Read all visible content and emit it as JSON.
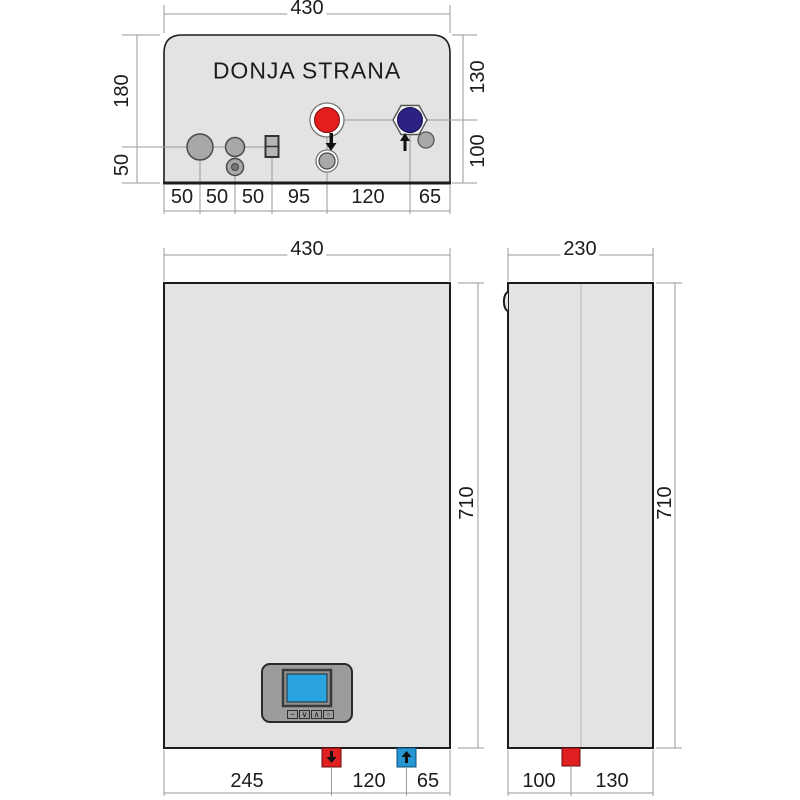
{
  "title": "DONJA STRANA",
  "views": {
    "bottom": {
      "dim_width": "430",
      "dims_left": [
        "180",
        "50"
      ],
      "dims_right": [
        "130",
        "100"
      ],
      "dims_bottom": [
        "50",
        "50",
        "50",
        "95",
        "120",
        "65"
      ]
    },
    "front": {
      "dim_width": "430",
      "dim_height": "710",
      "dims_bottom": [
        "245",
        "120",
        "65"
      ]
    },
    "side": {
      "dim_width": "230",
      "dim_height": "710",
      "dims_bottom": [
        "100",
        "130"
      ]
    }
  },
  "display": {
    "buttons": [
      "−",
      "∨",
      "∧",
      "▫"
    ]
  },
  "colors": {
    "body_fill": "#e3e3e3",
    "outline": "#1c1c1c",
    "dim_line": "#9a9a9a",
    "hot_port_red": "#e31e1e",
    "cold_port_navy": "#2b2284",
    "screen_blue": "#2aa5e0",
    "supply_square_red": "#e02020",
    "return_square_blue": "#2596d1",
    "metal_gray": "#a8a8a8",
    "panel_gray": "#9c9c9c"
  }
}
